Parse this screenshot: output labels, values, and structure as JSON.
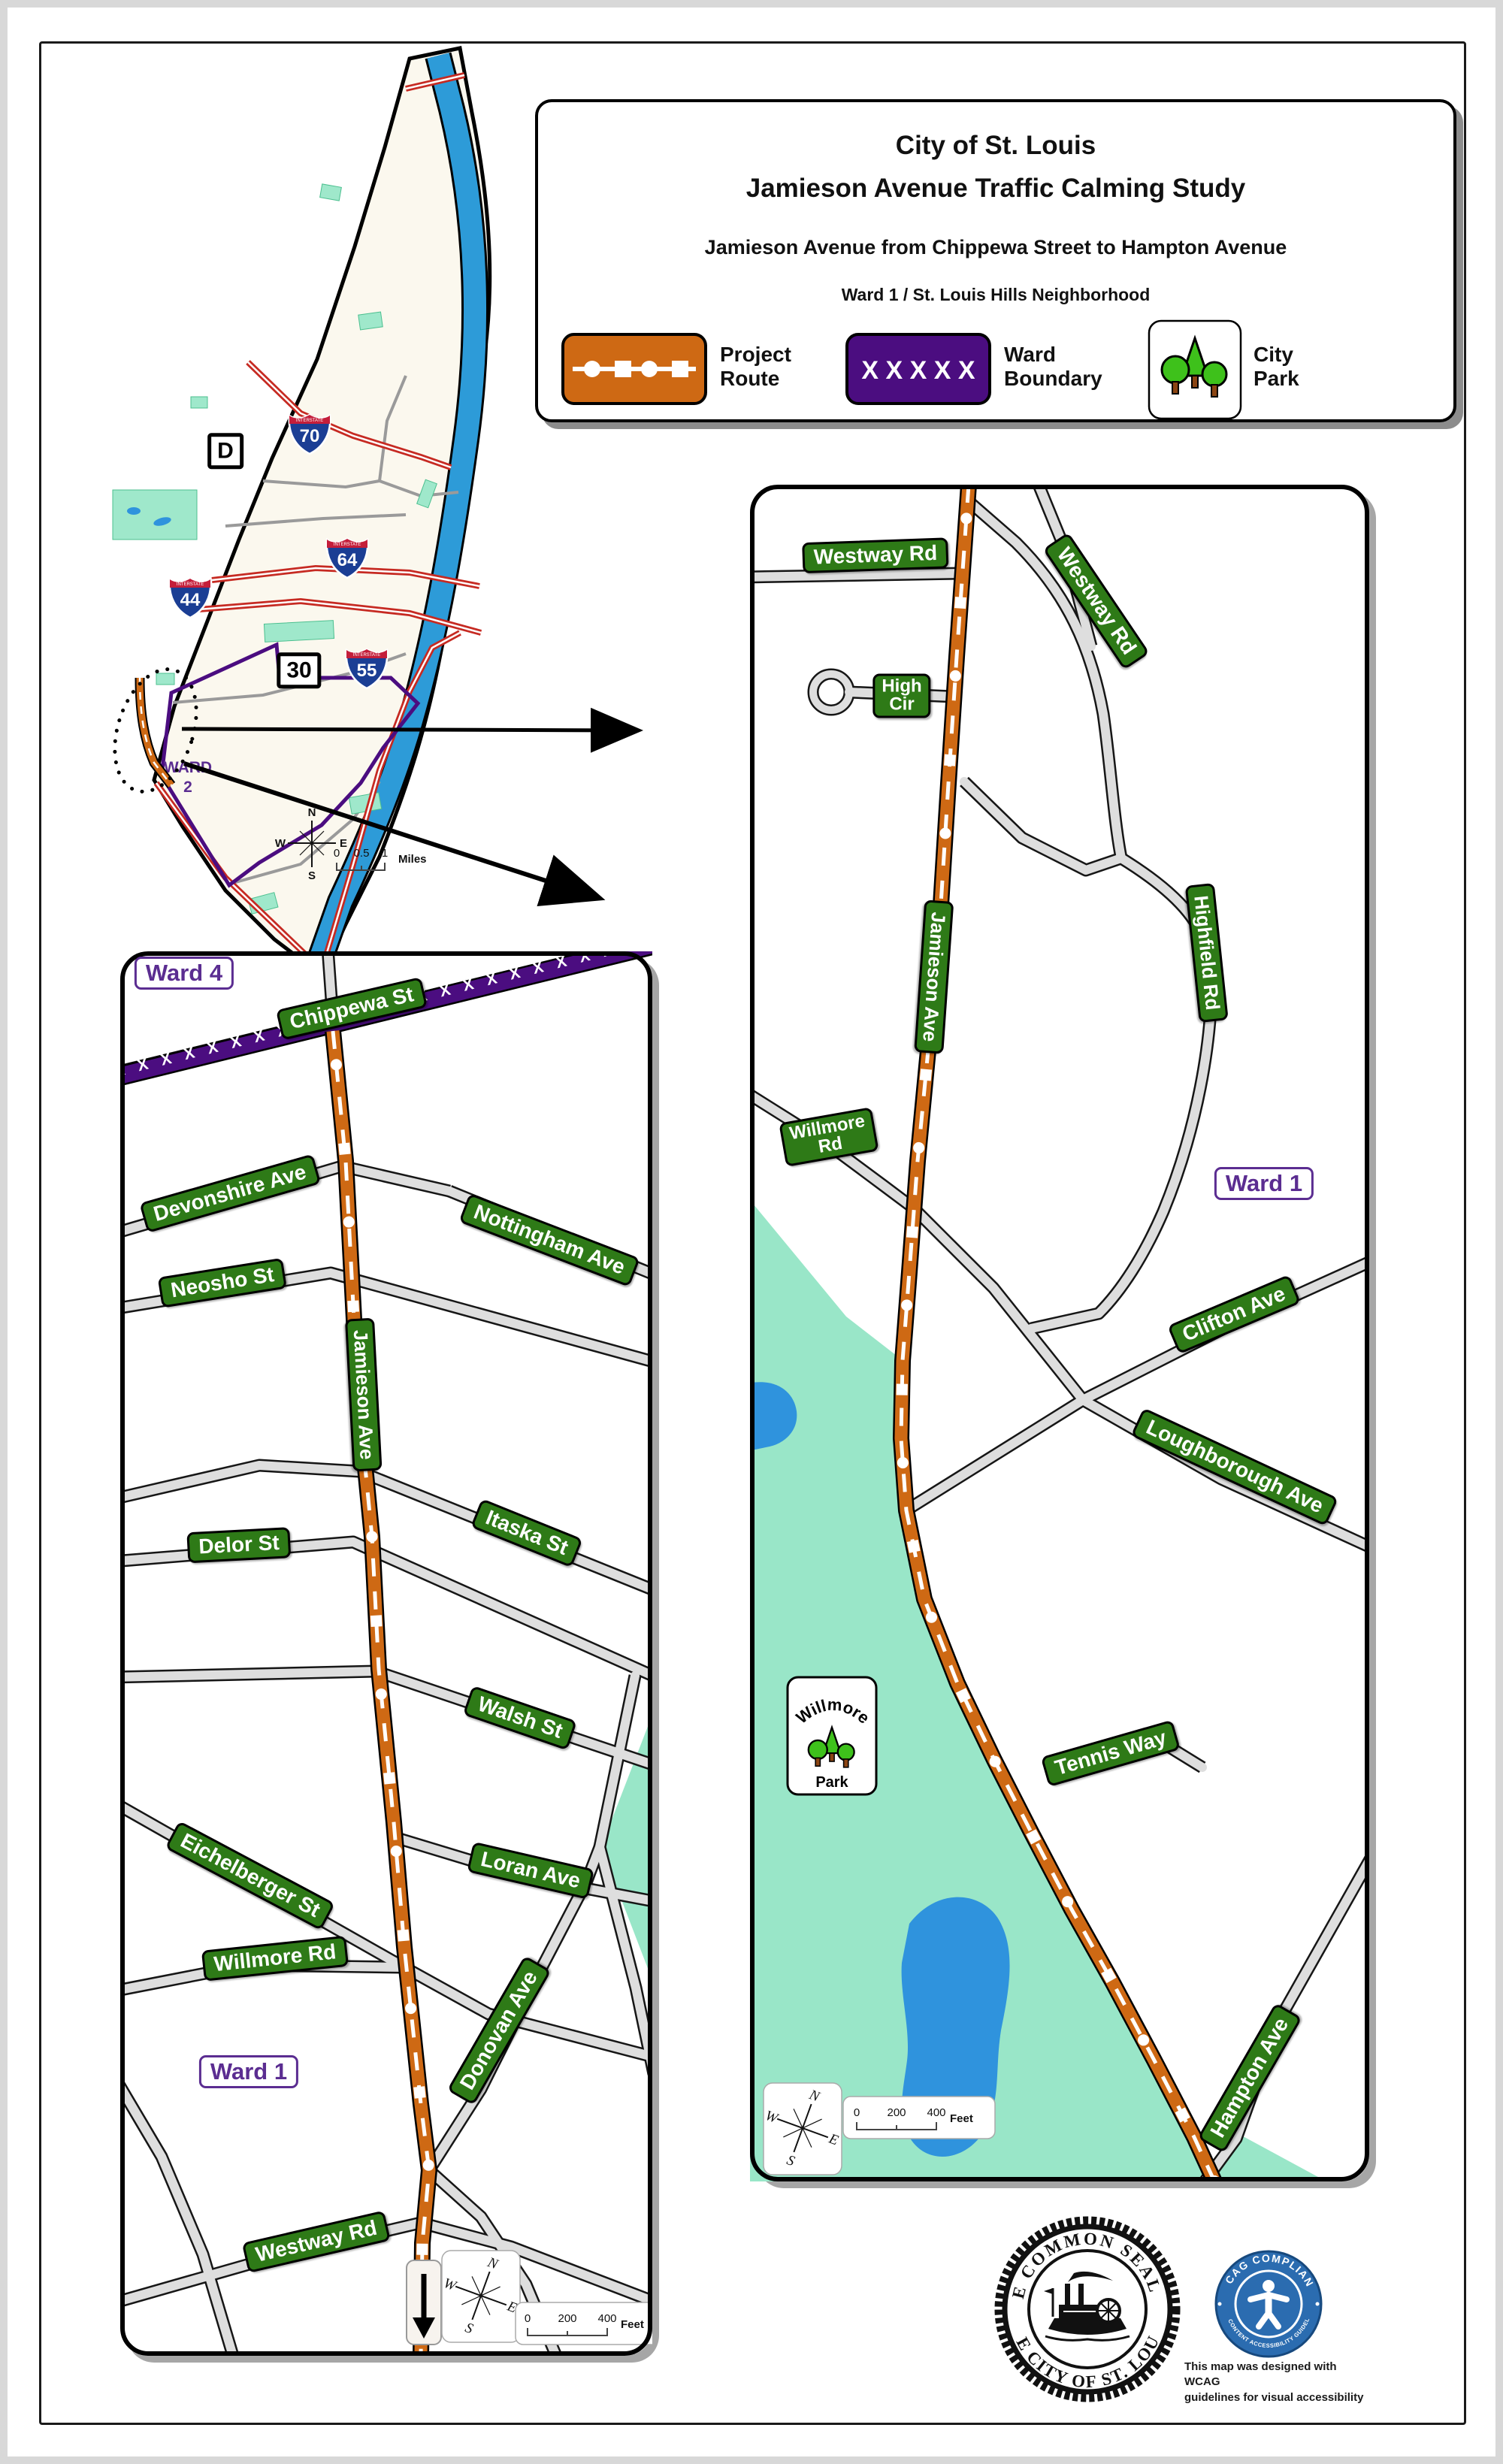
{
  "title_block": {
    "line1": "City of St. Louis",
    "line2": "Jamieson Avenue Traffic Calming Study",
    "line3": "Jamieson Avenue from Chippewa Street to Hampton Avenue",
    "line4": "Ward 1 / St. Louis Hills Neighborhood"
  },
  "legend": {
    "project": {
      "line1": "Project",
      "line2": "Route"
    },
    "ward": {
      "line1": "Ward",
      "line2": "Boundary",
      "pattern": "X X X X X"
    },
    "park": {
      "line1": "City",
      "line2": "Park"
    }
  },
  "overview_map": {
    "interstate_label": "INTERSTATE",
    "shields": {
      "i70": "70",
      "i64": "64",
      "i44": "44",
      "i55": "55"
    },
    "markers": {
      "d": "D",
      "r30": "30"
    },
    "ward2": {
      "line1": "WARD",
      "line2": "2"
    },
    "scale": {
      "a": "0",
      "b": "0.5",
      "c": "1",
      "unit": "Miles"
    }
  },
  "compass": {
    "n": "N",
    "e": "E",
    "s": "S",
    "w": "W"
  },
  "detail_scale": {
    "a": "0",
    "b": "200",
    "c": "400",
    "unit": "Feet"
  },
  "left_map": {
    "ward4": "Ward 4",
    "ward1": "Ward 1",
    "boundary_pattern": "X X X X X X X X X X X X X X X X X X X X X X X X X X X X X X",
    "signs": {
      "chippewa": "Chippewa St",
      "devonshire": "Devonshire Ave",
      "nottingham": "Nottingham Ave",
      "neosho": "Neosho St",
      "jamieson": "Jamieson Ave",
      "itaska": "Itaska St",
      "delor": "Delor St",
      "walsh": "Walsh St",
      "eichelberger": "Eichelberger St",
      "loran": "Loran Ave",
      "willmore": "Willmore Rd",
      "donovan": "Donovan Ave",
      "westway": "Westway Rd"
    }
  },
  "right_map": {
    "ward1": "Ward 1",
    "signs": {
      "westway": "Westway Rd",
      "high_line1": "High",
      "high_line2": "Cir",
      "jamieson": "Jamieson Ave",
      "highfield": "Highfield Rd",
      "willmore_line1": "Willmore",
      "willmore_line2": "Rd",
      "clifton": "Clifton Ave",
      "loughborough": "Loughborough Ave",
      "tennis": "Tennis Way",
      "hampton": "Hampton Ave"
    },
    "park": {
      "name": "Willmore",
      "word": "Park"
    }
  },
  "seal": {
    "arc_top": "THE COMMON SEAL OF",
    "arc_bottom": "THE CITY OF ST. LOUIS."
  },
  "wcag": {
    "arc_top": "WCAG COMPLIANT",
    "arc_bottom": "WEB CONTENT ACCESSIBILITY GUIDELINES",
    "caption1": "This map was designed with WCAG",
    "caption2": "guidelines for visual accessibility"
  },
  "colors": {
    "route_orange": "#CE6914",
    "ward_purple": "#4B0D80",
    "sign_green": "#2E7A17",
    "park_mint": "#99E6C8",
    "water_blue": "#2D9BD8",
    "wcag_blue": "#2B6CB0"
  }
}
